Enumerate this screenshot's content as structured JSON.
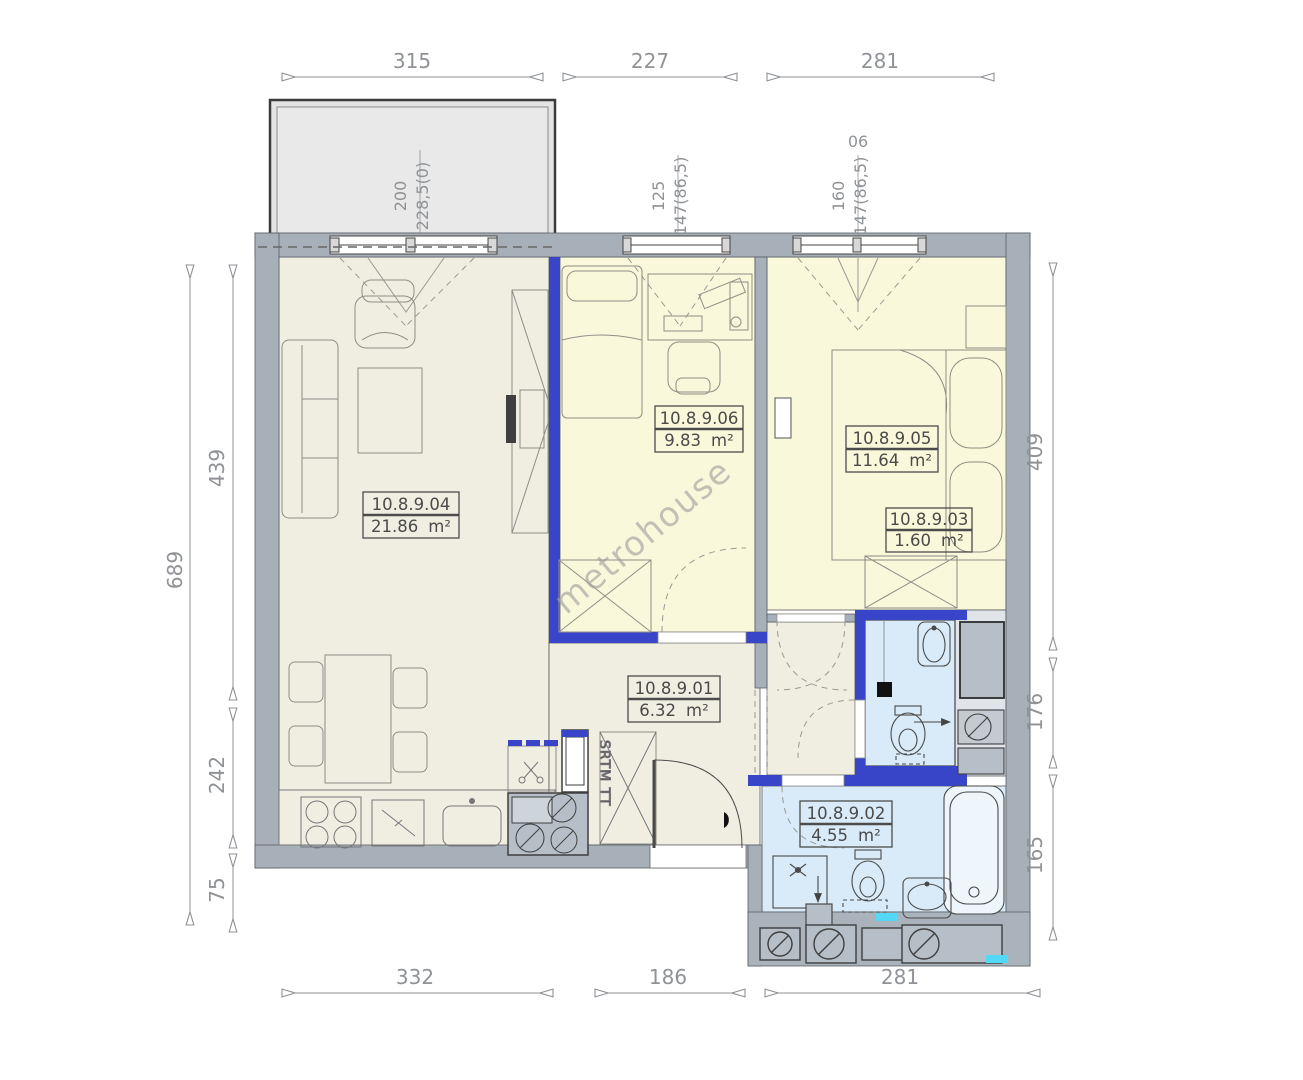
{
  "watermark": "metrohouse",
  "unit": "m²",
  "rooms": {
    "living": {
      "id": "10.8.9.04",
      "area": "21.86"
    },
    "room06": {
      "id": "10.8.9.06",
      "area": "9.83"
    },
    "bedroom": {
      "id": "10.8.9.05",
      "area": "11.64"
    },
    "closet": {
      "id": "10.8.9.03",
      "area": "1.60"
    },
    "hall": {
      "id": "10.8.9.01",
      "area": "6.32"
    },
    "bath": {
      "id": "10.8.9.02",
      "area": "4.55"
    }
  },
  "dims": {
    "top": [
      "315",
      "227",
      "281"
    ],
    "bottom": [
      "332",
      "186",
      "281"
    ],
    "left_outer": "689",
    "left_inner": [
      "439",
      "242",
      "75"
    ],
    "right": [
      "409",
      "176",
      "165"
    ]
  },
  "windows": {
    "balcony_door": {
      "width": "200",
      "height": "228,5(0)"
    },
    "window_small": {
      "width": "125",
      "height": "147(86,5)"
    },
    "window_large": {
      "width": "160",
      "height": "147(86,5)",
      "tag": "06"
    }
  },
  "labels": {
    "kitchen_unit": "SRTM TT"
  },
  "colors": {
    "wall_gray": "#a7afb8",
    "room_beige": "#f0eee1",
    "room_yellow": "#faf8da",
    "room_blue": "#d9ebf8",
    "accent_wall_blue": "#3845c8",
    "cyan_accent": "#53d9f5",
    "equipment_gray": "#b6bfc8",
    "balcony_gray": "#e3e3e3"
  }
}
